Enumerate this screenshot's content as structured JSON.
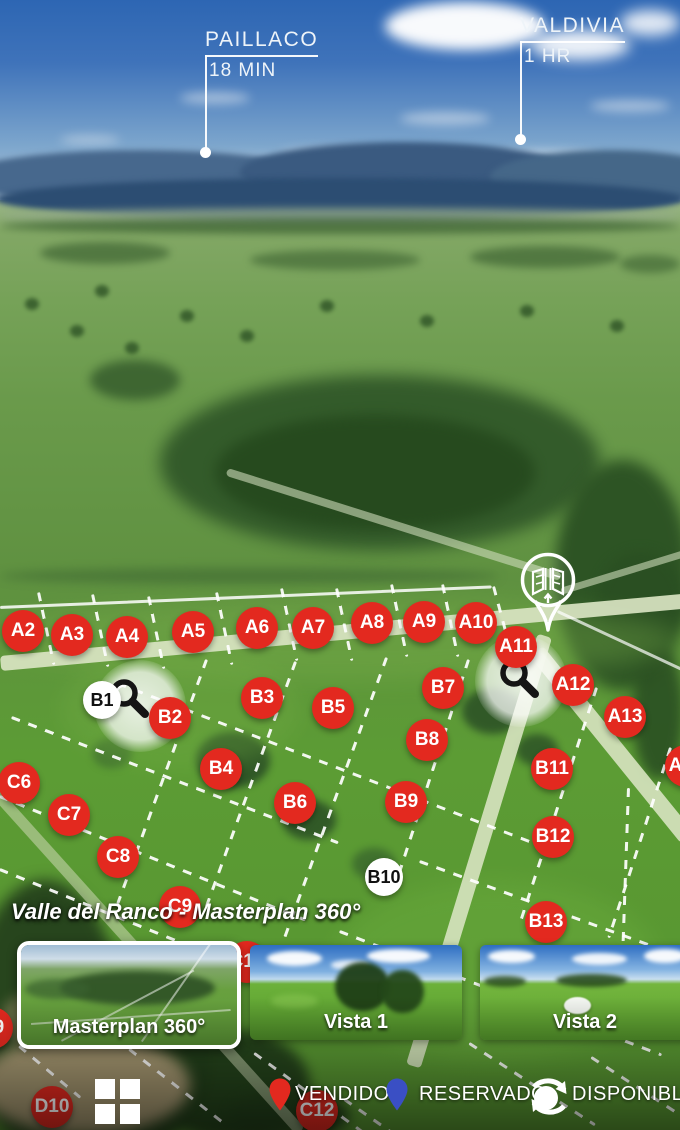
{
  "map": {
    "title": "Valle del Ranco - Masterplan 360°",
    "top_labels": [
      {
        "name": "PAILLACO",
        "time": "18 MIN"
      },
      {
        "name": "VALDIVIA",
        "time": "1 HR"
      }
    ],
    "markers": [
      {
        "id": "A2",
        "status": "vendido",
        "x": 23,
        "y": 631
      },
      {
        "id": "A3",
        "status": "vendido",
        "x": 72,
        "y": 635
      },
      {
        "id": "A4",
        "status": "vendido",
        "x": 127,
        "y": 637
      },
      {
        "id": "A5",
        "status": "vendido",
        "x": 193,
        "y": 632
      },
      {
        "id": "A6",
        "status": "vendido",
        "x": 257,
        "y": 628
      },
      {
        "id": "A7",
        "status": "vendido",
        "x": 313,
        "y": 628
      },
      {
        "id": "A8",
        "status": "vendido",
        "x": 372,
        "y": 623
      },
      {
        "id": "A9",
        "status": "vendido",
        "x": 424,
        "y": 622
      },
      {
        "id": "A10",
        "status": "vendido",
        "x": 476,
        "y": 623
      },
      {
        "id": "A11",
        "status": "vendido",
        "x": 516,
        "y": 647
      },
      {
        "id": "A12",
        "status": "vendido",
        "x": 573,
        "y": 685
      },
      {
        "id": "A13",
        "status": "vendido",
        "x": 625,
        "y": 717
      },
      {
        "id": "A14",
        "status": "vendido",
        "x": 686,
        "y": 766
      },
      {
        "id": "B1",
        "status": "disponible",
        "x": 102,
        "y": 700
      },
      {
        "id": "B2",
        "status": "vendido",
        "x": 170,
        "y": 718
      },
      {
        "id": "B3",
        "status": "vendido",
        "x": 262,
        "y": 698
      },
      {
        "id": "B4",
        "status": "vendido",
        "x": 221,
        "y": 769
      },
      {
        "id": "B5",
        "status": "vendido",
        "x": 333,
        "y": 708
      },
      {
        "id": "B6",
        "status": "vendido",
        "x": 295,
        "y": 803
      },
      {
        "id": "B7",
        "status": "vendido",
        "x": 443,
        "y": 688
      },
      {
        "id": "B8",
        "status": "vendido",
        "x": 427,
        "y": 740
      },
      {
        "id": "B9",
        "status": "vendido",
        "x": 406,
        "y": 802
      },
      {
        "id": "B10",
        "status": "disponible",
        "x": 384,
        "y": 877
      },
      {
        "id": "B11",
        "status": "vendido",
        "x": 552,
        "y": 769
      },
      {
        "id": "B12",
        "status": "vendido",
        "x": 553,
        "y": 837
      },
      {
        "id": "B13",
        "status": "vendido",
        "x": 546,
        "y": 922
      },
      {
        "id": "C6",
        "status": "vendido",
        "x": 19,
        "y": 783
      },
      {
        "id": "C7",
        "status": "vendido",
        "x": 69,
        "y": 815
      },
      {
        "id": "C8",
        "status": "vendido",
        "x": 118,
        "y": 857
      },
      {
        "id": "C9",
        "status": "vendido",
        "x": 180,
        "y": 907
      },
      {
        "id": "C10",
        "status": "vendido",
        "x": 247,
        "y": 962
      },
      {
        "id": "C12",
        "status": "vendido",
        "x": 317,
        "y": 1111
      },
      {
        "id": "D9",
        "status": "vendido",
        "x": -8,
        "y": 1028
      },
      {
        "id": "D10",
        "status": "vendido",
        "x": 52,
        "y": 1107
      }
    ]
  },
  "thumbnails": [
    {
      "label": "Masterplan 360°",
      "selected": true
    },
    {
      "label": "Vista 1",
      "selected": false
    },
    {
      "label": "Vista 2",
      "selected": false
    }
  ],
  "legend": [
    {
      "label": "VENDIDO",
      "icon": "pin",
      "color": "#e3291f"
    },
    {
      "label": "RESERVADO",
      "icon": "pin",
      "color": "#3a4fc4"
    },
    {
      "label": "DISPONIBLE",
      "icon": "rotate-360",
      "color": "#ffffff"
    }
  ],
  "colors": {
    "lot_sold": "#e3291f",
    "lot_available_bg": "#ffffff",
    "lot_available_text": "#111111",
    "reserved": "#3a4fc4"
  }
}
